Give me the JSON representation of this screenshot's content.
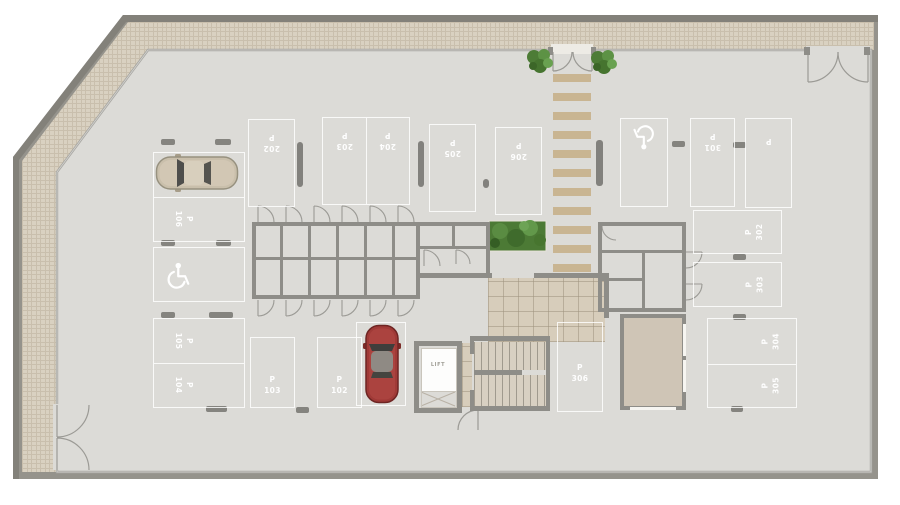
{
  "plan_type": "basement-parking-floor-plan",
  "colors": {
    "floor": "#dcdbd7",
    "outer_wall": "#95938c",
    "pavers": "#d9d1c1",
    "interior_wall": "#8e8d88",
    "marking_white": "#ffffff",
    "walkway_stripe": "#c9b592",
    "lobby_tile": "#d7cdbb",
    "greenery": "#4d7c36",
    "car_red": "#a03a37",
    "car_silver": "#c9bfab"
  },
  "spots": {
    "s202": {
      "p": "P",
      "n": "202"
    },
    "s203": {
      "p": "P",
      "n": "203"
    },
    "s204": {
      "p": "P",
      "n": "204"
    },
    "s205": {
      "p": "P",
      "n": "205"
    },
    "s206": {
      "p": "P",
      "n": "206"
    },
    "s301": {
      "p": "P",
      "n": "301"
    },
    "s_blank": {
      "p": "P",
      "n": ""
    },
    "s302": {
      "p": "P",
      "n": "302"
    },
    "s303": {
      "p": "P",
      "n": "303"
    },
    "s304": {
      "p": "P",
      "n": "304"
    },
    "s305": {
      "p": "P",
      "n": "305"
    },
    "s306": {
      "p": "P",
      "n": "306"
    },
    "s106": {
      "p": "P",
      "n": "106"
    },
    "s105": {
      "p": "P",
      "n": "105"
    },
    "s104": {
      "p": "P",
      "n": "104"
    },
    "s103": {
      "p": "P",
      "n": "103"
    },
    "s102": {
      "p": "P",
      "n": "102"
    }
  },
  "elevator": {
    "label": "LIFT"
  },
  "icons": {
    "accessible_spots": 2,
    "icon_name": "wheelchair-icon"
  }
}
